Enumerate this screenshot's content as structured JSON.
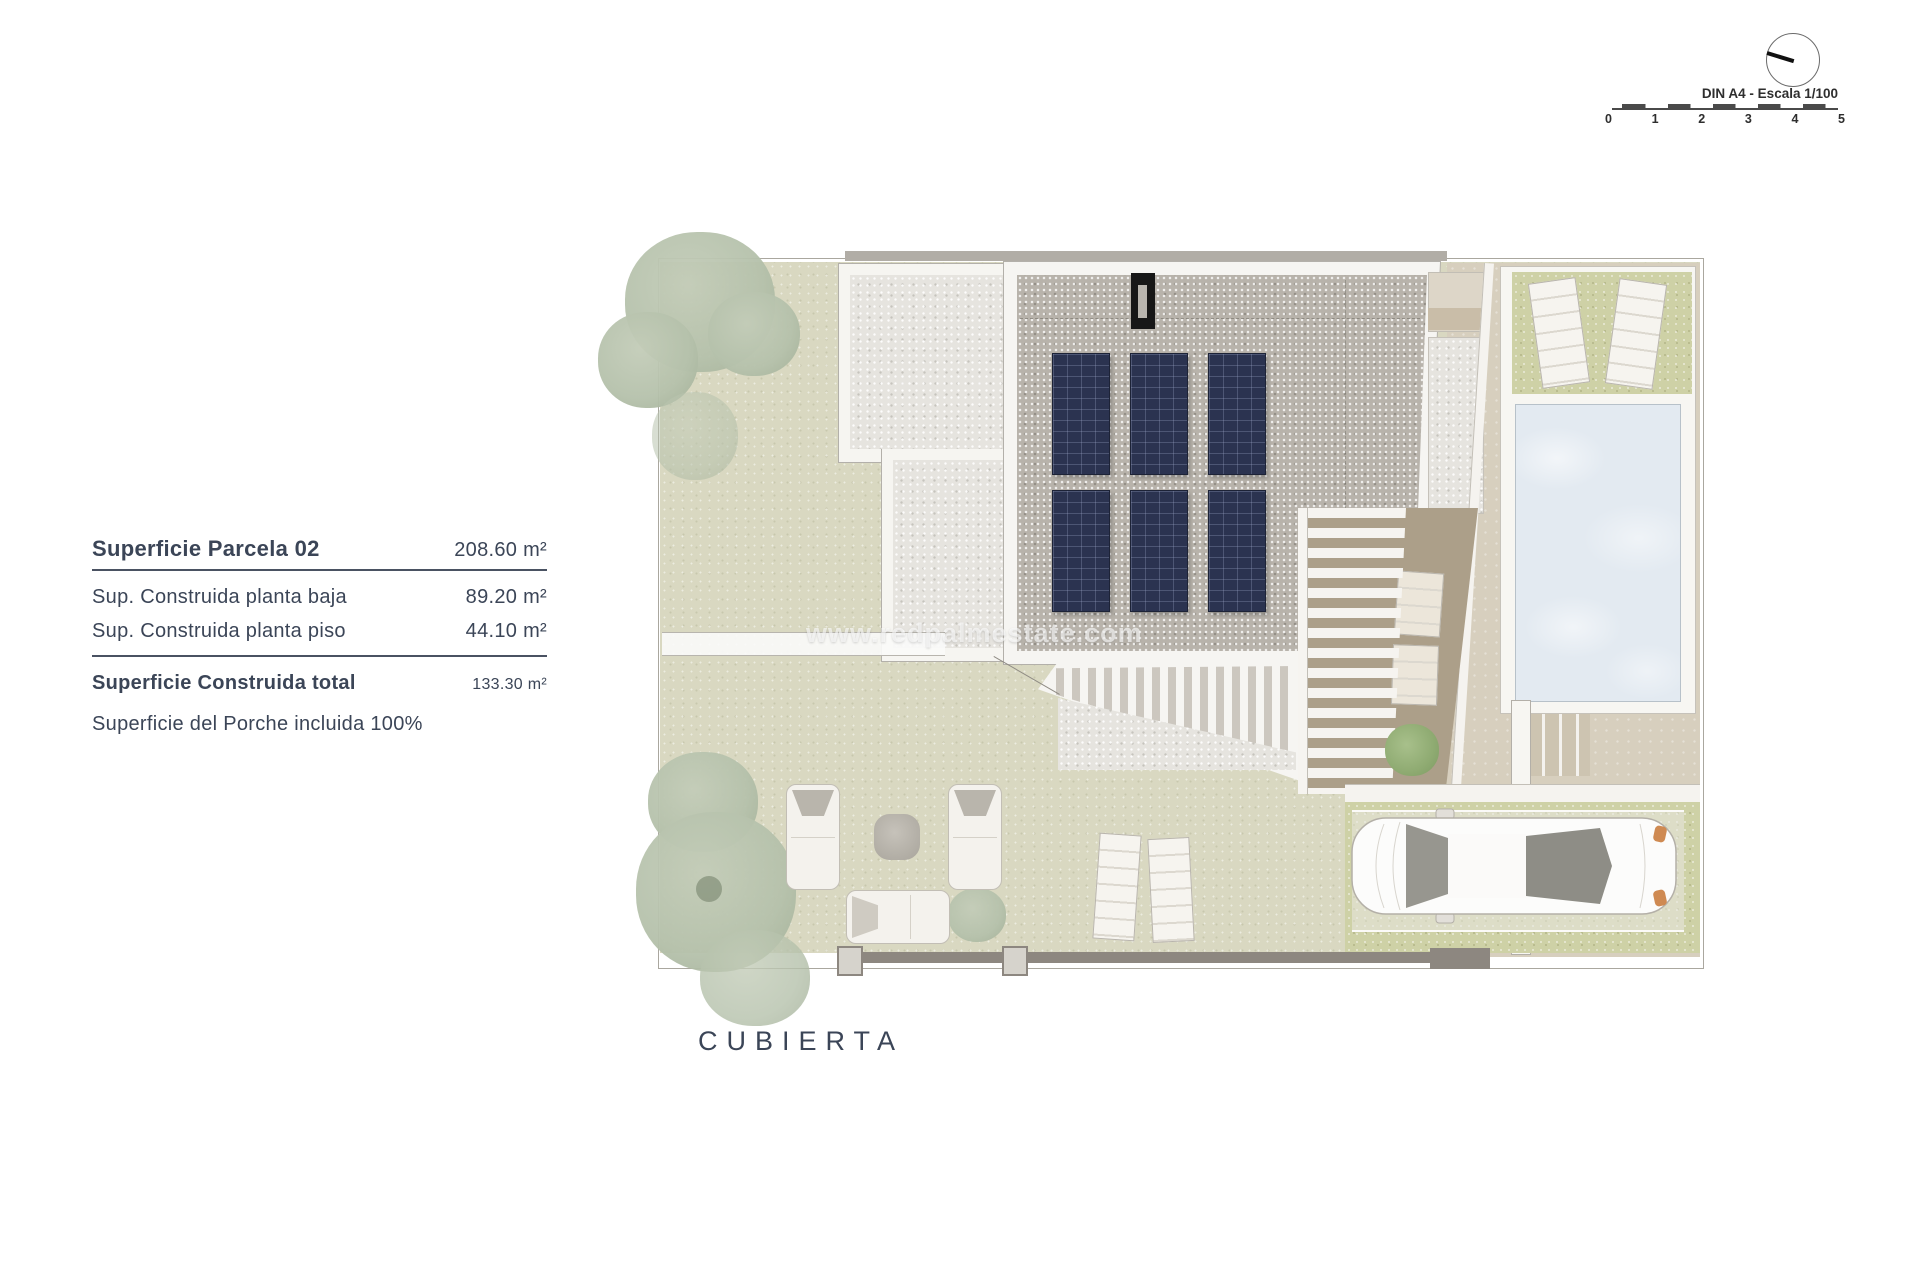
{
  "plan_label": "CUBIERTA",
  "watermark": "www.redpalmestate.com",
  "info_panel": {
    "title": {
      "label": "Superficie Parcela 02",
      "value": "208.60 m²"
    },
    "rows": [
      {
        "label": "Sup. Construida planta baja",
        "value": "89.20 m²"
      },
      {
        "label": "Sup. Construida planta piso",
        "value": "44.10 m²"
      }
    ],
    "total": {
      "label": "Superficie Construida total",
      "value": "133.30 m²"
    },
    "note": "Superficie del Porche incluida 100%"
  },
  "scale_indicator": {
    "label": "DIN A4 - Escala 1/100",
    "ticks": [
      "0",
      "1",
      "2",
      "3",
      "4",
      "5"
    ]
  },
  "colors": {
    "text": "#3b4557",
    "divider": "#4a5262",
    "grass": "#d9d8c1",
    "grass_bright": "#ced1a6",
    "gravel_light": "#e6e4df",
    "gravel_dark": "#b8b3ab",
    "panel": "#2b3350",
    "pool_water": "#e3eaf1",
    "paving": "#d7cfbe",
    "terrace": "#ac9f89",
    "tree": "#b5c1ab",
    "tree_bright": "#8fab72",
    "fence": "#8d8780",
    "watermark": "rgba(255,255,255,0.62)"
  }
}
